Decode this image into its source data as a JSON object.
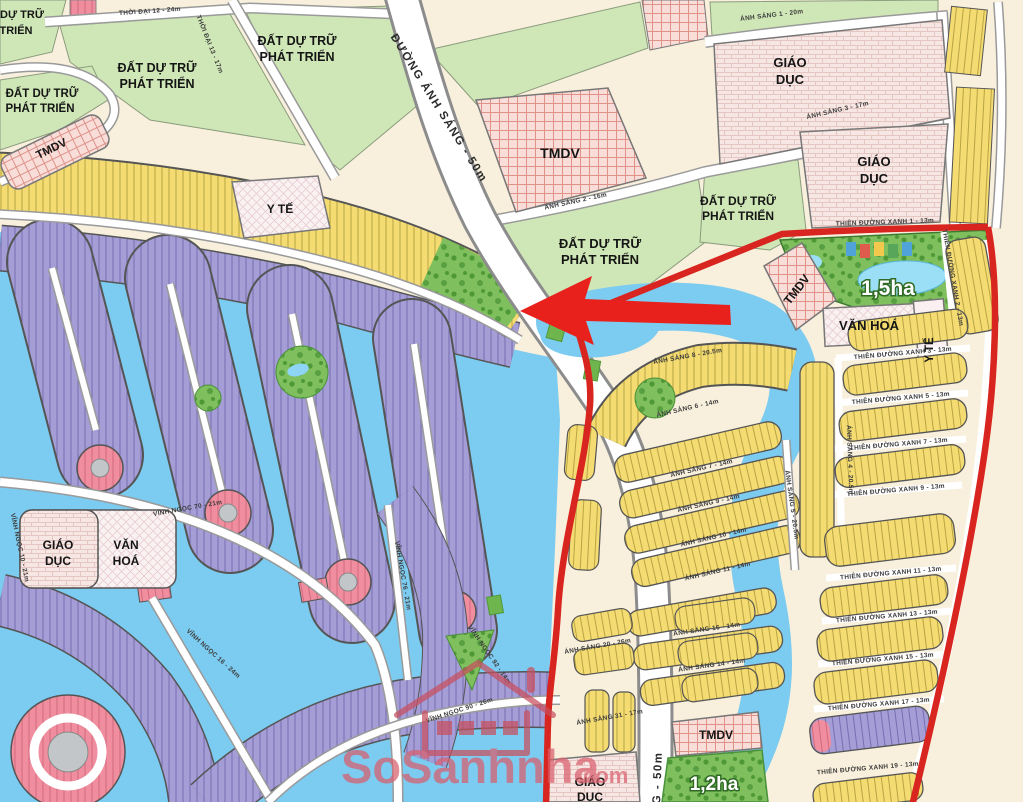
{
  "watermark": {
    "brand": "SoSanhnha",
    "suffix": ".com"
  },
  "zones": {
    "reserve_line1": "ĐẤT DỰ TRỮ",
    "reserve_line2": "PHÁT TRIỂN",
    "reserve_cut_line1": "DỰ TRỮ",
    "reserve_cut_line2": "TRIỂN",
    "tmdv": "TMDV",
    "giao_duc_line1": "GIÁO",
    "giao_duc_line2": "DỤC",
    "van_hoa": "VĂN HOÁ",
    "van_hoa_line1": "VĂN",
    "van_hoa_line2": "HOÁ",
    "y_te": "Y TẾ",
    "park_area_large": "1,5ha",
    "park_area_small": "1,2ha"
  },
  "roads": {
    "avenue": "ĐƯỜNG ÁNH SÁNG - 50m",
    "avenue_bottom": "G - 50m",
    "thoi_dai_12": "THỜI ĐẠI 12 - 24m",
    "thoi_dai_13": "THỜI ĐẠI 13 - 17m",
    "anh_sang_1": "ÁNH SÁNG 1 - 20m",
    "anh_sang_2": "ÁNH SÁNG 2 - 16m",
    "anh_sang_3": "ÁNH SÁNG 3 - 17m",
    "anh_sang_4": "ÁNH SÁNG 4 - 20.5m",
    "anh_sang_5": "ÁNH SÁNG 5 - 20.5m",
    "anh_sang_6": "ÁNH SÁNG 6 - 14m",
    "anh_sang_7": "ÁNH SÁNG 7 - 14m",
    "anh_sang_8": "ÁNH SÁNG 8 - 20.5m",
    "anh_sang_9": "ÁNH SÁNG 9 - 14m",
    "anh_sang_10": "ÁNH SÁNG 10 - 14m",
    "anh_sang_11": "ÁNH SÁNG 11 - 14m",
    "anh_sang_14": "ÁNH SÁNG 14 - 14m",
    "anh_sang_16": "ÁNH SÁNG 16 - 14m",
    "anh_sang_20": "ÁNH SÁNG 20 - 26m",
    "anh_sang_31": "ÁNH SÁNG 31 - 17m",
    "tdx_1": "THIÊN ĐƯỜNG XANH 1 - 13m",
    "tdx_2": "THIÊN ĐƯỜNG XANH 2 - 13m",
    "tdx_3": "THIÊN ĐƯỜNG XANH 3 - 13m",
    "tdx_5": "THIÊN ĐƯỜNG XANH 5 - 13m",
    "tdx_7": "THIÊN ĐƯỜNG XANH 7 - 13m",
    "tdx_9": "THIÊN ĐƯỜNG XANH 9 - 13m",
    "tdx_11": "THIÊN ĐƯỜNG XANH 11 - 13m",
    "tdx_13": "THIÊN ĐƯỜNG XANH 13 - 13m",
    "tdx_15": "THIÊN ĐƯỜNG XANH 15 - 13m",
    "tdx_17": "THIÊN ĐƯỜNG XANH 17 - 13m",
    "tdx_19": "THIÊN ĐƯỜNG XANH 19 - 13m",
    "vinh_ngoc_10": "VĨNH NGỌC 10 - 21m",
    "vinh_ngoc_16": "VĨNH NGỌC 16 - 24m",
    "vinh_ngoc_70": "VĨNH NGỌC 70 - 21m",
    "vinh_ngoc_76": "VĨNH NGỌC 76 - 21m",
    "vinh_ngoc_90": "VĨNH NGỌC 90 - 26m",
    "vinh_ngoc_92": "VĨNH NGỌC 92 - 14m"
  },
  "colors": {
    "boundary_red": "#D9251F",
    "arrow_red": "#E8211D",
    "water_blue": "#7CCBF0",
    "lot_yellow": "#F4DC72",
    "lot_purple": "#A49DD6",
    "lot_pink": "#F08EA0",
    "reserve_green": "#CFE7B6",
    "park_green": "#7FBF5D",
    "background_cream": "#F8F0DC",
    "watermark_pink": "#DD5E6B"
  }
}
